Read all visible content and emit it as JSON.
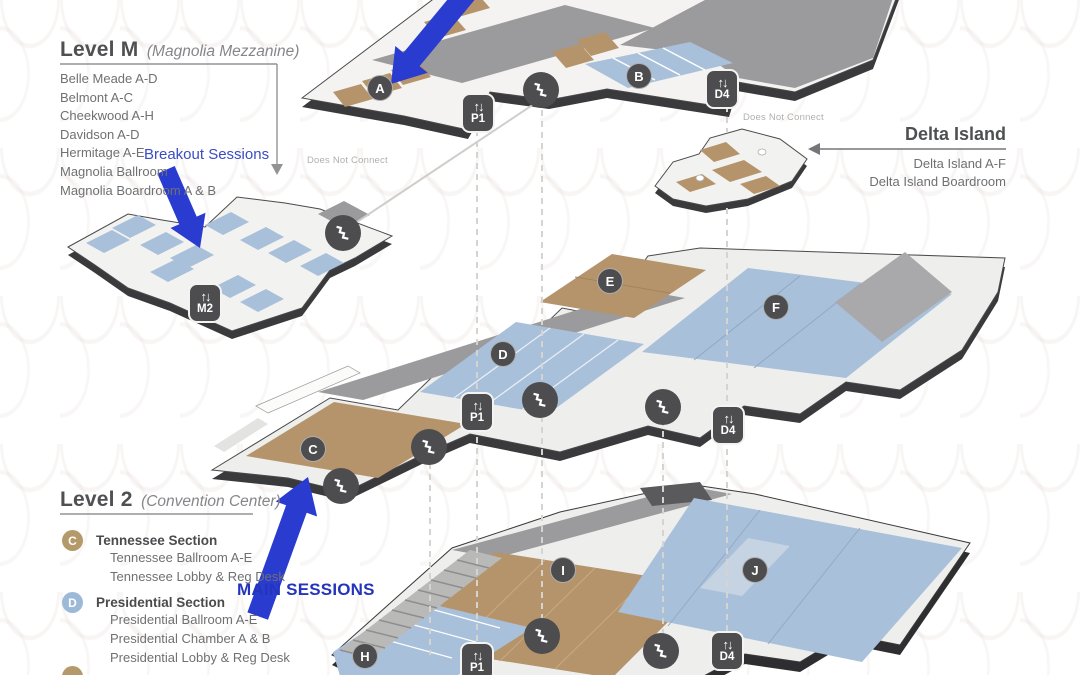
{
  "level_m": {
    "title": "Level M",
    "subtitle": "(Magnolia Mezzanine)",
    "rooms": [
      "Belle Meade A-D",
      "Belmont A-C",
      "Cheekwood A-H",
      "Davidson A-D",
      "Hermitage A-E",
      "Magnolia Ballroom",
      "Magnolia Boardroom A & B"
    ]
  },
  "level_2": {
    "title": "Level 2",
    "subtitle": "(Convention Center)",
    "sections": [
      {
        "letter": "C",
        "name": "Tennessee Section",
        "rooms": [
          "Tennessee Ballroom A-E",
          "Tennessee Lobby & Reg Desk"
        ]
      },
      {
        "letter": "D",
        "name": "Presidential Section",
        "rooms": [
          "Presidential Ballroom A-E",
          "Presidential Chamber A & B",
          "Presidential Lobby & Reg Desk"
        ]
      }
    ]
  },
  "delta_island": {
    "title": "Delta Island",
    "rooms": [
      "Delta Island A-F",
      "Delta Island Boardroom"
    ]
  },
  "annotations": {
    "breakout_sessions": "Breakout Sessions",
    "main_sessions": "MAIN SESSIONS",
    "does_not_connect": "Does Not Connect"
  },
  "markers": {
    "a": "A",
    "b": "B",
    "c": "C",
    "d": "D",
    "e": "E",
    "f": "F",
    "h": "H",
    "i": "I",
    "j": "J"
  },
  "elevators": {
    "p1": "P1",
    "d4": "D4",
    "m2": "M2"
  },
  "icons": {
    "elevator_glyph": "↑↓"
  },
  "colors": {
    "annotation_blue": "#2a3bd0",
    "marker_dark": "#4d4d4f",
    "room_tan": "#b5946c",
    "room_blue": "#a9c0da",
    "roof_gray": "#9b9b9d",
    "legend_c": "#b49a6a",
    "legend_d": "#9db9d8"
  }
}
